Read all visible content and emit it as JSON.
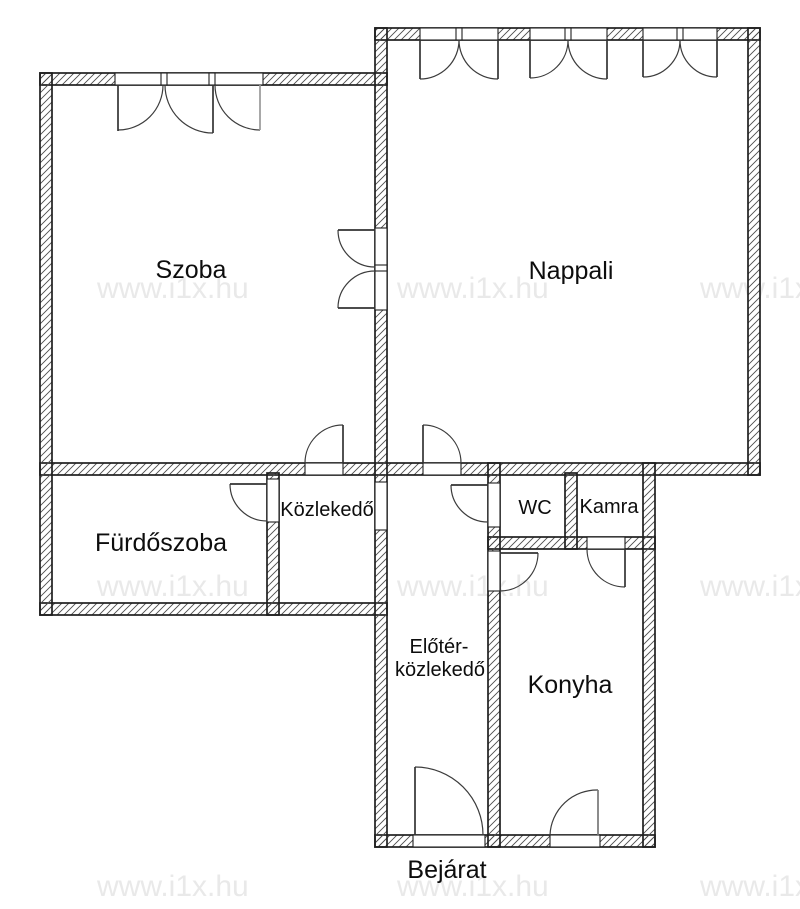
{
  "floorplan": {
    "width": 800,
    "height": 909,
    "colors": {
      "background": "#ffffff",
      "line": "#1f1f1f",
      "hatch": "#4d4d4d",
      "arc": "#3c3c3c",
      "text": "#0d0d0d",
      "watermark": "#e9e9e9"
    },
    "watermarks": {
      "text": "www.i1x.hu",
      "size": 30,
      "positions": [
        [
          97,
          298
        ],
        [
          397,
          298
        ],
        [
          700,
          298
        ],
        [
          97,
          596
        ],
        [
          397,
          596
        ],
        [
          700,
          596
        ],
        [
          97,
          896
        ],
        [
          397,
          896
        ],
        [
          700,
          896
        ]
      ]
    },
    "walls": [
      [
        375,
        28,
        385,
        12
      ],
      [
        40,
        73,
        347,
        12
      ],
      [
        40,
        463,
        720,
        12
      ],
      [
        40,
        603,
        347,
        12
      ],
      [
        488,
        537,
        167,
        12
      ],
      [
        375,
        835,
        280,
        12
      ],
      [
        40,
        73,
        12,
        542
      ],
      [
        748,
        28,
        12,
        447
      ],
      [
        375,
        28,
        12,
        819
      ],
      [
        267,
        473,
        12,
        142
      ],
      [
        488,
        463,
        12,
        384
      ],
      [
        565,
        473,
        12,
        76
      ],
      [
        643,
        463,
        12,
        384
      ]
    ],
    "openings": [
      {
        "name": "szoba-window-opening",
        "x": 115,
        "y": 73,
        "w": 148,
        "h": 12
      },
      {
        "name": "nappali-window-1-opening",
        "x": 420,
        "y": 28,
        "w": 78,
        "h": 12
      },
      {
        "name": "nappali-window-2-opening",
        "x": 530,
        "y": 28,
        "w": 77,
        "h": 12
      },
      {
        "name": "nappali-window-3-opening",
        "x": 643,
        "y": 28,
        "w": 74,
        "h": 12
      },
      {
        "name": "szoba-kozlekedo-door-opening",
        "x": 305,
        "y": 463,
        "w": 38,
        "h": 12
      },
      {
        "name": "nappali-eloter-door-opening",
        "x": 423,
        "y": 463,
        "w": 38,
        "h": 12
      },
      {
        "name": "szoba-nappali-double-door-opening",
        "x": 375,
        "y": 228,
        "w": 12,
        "h": 82
      },
      {
        "name": "kozlekedo-eloter-passage",
        "x": 375,
        "y": 482,
        "w": 12,
        "h": 48
      },
      {
        "name": "furdoszoba-door-opening",
        "x": 267,
        "y": 479,
        "w": 12,
        "h": 43
      },
      {
        "name": "wc-door-opening",
        "x": 488,
        "y": 483,
        "w": 12,
        "h": 44
      },
      {
        "name": "konyha-door-opening",
        "x": 488,
        "y": 551,
        "w": 12,
        "h": 40
      },
      {
        "name": "kamra-door-opening",
        "x": 587,
        "y": 537,
        "w": 38,
        "h": 12
      },
      {
        "name": "bejarat-door-opening",
        "x": 413,
        "y": 835,
        "w": 72,
        "h": 12
      },
      {
        "name": "konyha-window-opening",
        "x": 550,
        "y": 835,
        "w": 50,
        "h": 12
      }
    ],
    "mullions": [
      [
        161,
        73,
        6,
        12
      ],
      [
        209,
        73,
        6,
        12
      ],
      [
        456,
        28,
        6,
        12
      ],
      [
        565,
        28,
        6,
        12
      ],
      [
        677,
        28,
        6,
        12
      ],
      [
        375,
        265,
        12,
        6
      ]
    ],
    "arcs": [
      {
        "name": "szoba-window-swing-left",
        "from": [
          163,
          85
        ],
        "to": [
          118,
          130
        ],
        "r": 45,
        "sweep": 1
      },
      {
        "name": "szoba-window-swing-mid",
        "from": [
          165,
          85
        ],
        "to": [
          213,
          133
        ],
        "r": 48,
        "sweep": 0
      },
      {
        "name": "szoba-window-swing-right",
        "from": [
          215,
          85
        ],
        "to": [
          260,
          130
        ],
        "r": 45,
        "sweep": 0
      },
      {
        "name": "nappali-window-1-swing-left",
        "from": [
          459,
          40
        ],
        "to": [
          420,
          79
        ],
        "r": 39,
        "sweep": 1
      },
      {
        "name": "nappali-window-1-swing-right",
        "from": [
          459,
          40
        ],
        "to": [
          498,
          79
        ],
        "r": 39,
        "sweep": 0
      },
      {
        "name": "nappali-window-2-swing-left",
        "from": [
          568,
          40
        ],
        "to": [
          530,
          78
        ],
        "r": 38,
        "sweep": 1
      },
      {
        "name": "nappali-window-2-swing-right",
        "from": [
          568,
          40
        ],
        "to": [
          607,
          79
        ],
        "r": 39,
        "sweep": 0
      },
      {
        "name": "nappali-window-3-swing-left",
        "from": [
          680,
          40
        ],
        "to": [
          643,
          77
        ],
        "r": 37,
        "sweep": 1
      },
      {
        "name": "nappali-window-3-swing-right",
        "from": [
          680,
          40
        ],
        "to": [
          717,
          77
        ],
        "r": 37,
        "sweep": 0
      },
      {
        "name": "szoba-door-swing",
        "from": [
          305,
          463
        ],
        "to": [
          343,
          425
        ],
        "r": 38,
        "sweep": 1
      },
      {
        "name": "nappali-door-swing",
        "from": [
          461,
          463
        ],
        "to": [
          423,
          425
        ],
        "r": 38,
        "sweep": 0
      },
      {
        "name": "double-door-upper-swing",
        "from": [
          338,
          230
        ],
        "to": [
          375,
          267
        ],
        "r": 37,
        "sweep": 0
      },
      {
        "name": "double-door-lower-swing",
        "from": [
          338,
          308
        ],
        "to": [
          375,
          271
        ],
        "r": 37,
        "sweep": 1
      },
      {
        "name": "furdoszoba-door-swing",
        "from": [
          230,
          484
        ],
        "to": [
          267,
          521
        ],
        "r": 37,
        "sweep": 0
      },
      {
        "name": "wc-door-swing",
        "from": [
          451,
          485
        ],
        "to": [
          488,
          522
        ],
        "r": 37,
        "sweep": 0
      },
      {
        "name": "konyha-door-swing",
        "from": [
          538,
          553
        ],
        "to": [
          500,
          591
        ],
        "r": 38,
        "sweep": 1
      },
      {
        "name": "kamra-door-swing",
        "from": [
          587,
          549
        ],
        "to": [
          625,
          587
        ],
        "r": 38,
        "sweep": 0
      },
      {
        "name": "bejarat-door-swing",
        "from": [
          415,
          767
        ],
        "to": [
          483,
          835
        ],
        "r": 68,
        "sweep": 1
      },
      {
        "name": "konyha-window-swing",
        "from": [
          550,
          835
        ],
        "to": [
          598,
          790
        ],
        "r": 47,
        "sweep": 1
      }
    ],
    "leaves": [
      [
        118,
        85,
        118,
        131,
        "#333333"
      ],
      [
        213,
        85,
        213,
        133,
        "#333333"
      ],
      [
        260,
        85,
        260,
        130,
        "#999999"
      ],
      [
        420,
        40,
        420,
        79,
        "#333333"
      ],
      [
        498,
        40,
        498,
        79,
        "#333333"
      ],
      [
        530,
        40,
        530,
        78,
        "#333333"
      ],
      [
        607,
        40,
        607,
        79,
        "#333333"
      ],
      [
        643,
        40,
        643,
        77,
        "#333333"
      ],
      [
        717,
        40,
        717,
        77,
        "#333333"
      ],
      [
        343,
        425,
        343,
        463,
        "#333333"
      ],
      [
        423,
        425,
        423,
        463,
        "#333333"
      ],
      [
        338,
        230,
        375,
        230,
        "#333333"
      ],
      [
        338,
        308,
        375,
        308,
        "#333333"
      ],
      [
        230,
        484,
        267,
        484,
        "#333333"
      ],
      [
        451,
        485,
        488,
        485,
        "#333333"
      ],
      [
        500,
        553,
        538,
        553,
        "#333333"
      ],
      [
        625,
        549,
        625,
        587,
        "#333333"
      ],
      [
        415,
        767,
        415,
        835,
        "#333333"
      ],
      [
        598,
        790,
        598,
        835,
        "#777777"
      ]
    ],
    "labels": [
      {
        "id": "szoba",
        "text": "Szoba",
        "x": 191,
        "y": 278,
        "size": 25
      },
      {
        "id": "nappali",
        "text": "Nappali",
        "x": 571,
        "y": 279,
        "size": 25
      },
      {
        "id": "furdoszoba",
        "text": "Fürdőszoba",
        "x": 161,
        "y": 551,
        "size": 25
      },
      {
        "id": "kozlekedo",
        "text": "Közlekedő",
        "x": 327,
        "y": 516,
        "size": 20
      },
      {
        "id": "wc",
        "text": "WC",
        "x": 535,
        "y": 514,
        "size": 20
      },
      {
        "id": "kamra",
        "text": "Kamra",
        "x": 609,
        "y": 513,
        "size": 20
      },
      {
        "id": "eloter-line1",
        "text": "Előtér-",
        "x": 439,
        "y": 653,
        "size": 20
      },
      {
        "id": "eloter-line2",
        "text": "közlekedő",
        "x": 440,
        "y": 676,
        "size": 20
      },
      {
        "id": "konyha",
        "text": "Konyha",
        "x": 570,
        "y": 693,
        "size": 25
      },
      {
        "id": "bejarat",
        "text": "Bejárat",
        "x": 447,
        "y": 878,
        "size": 25
      }
    ]
  }
}
